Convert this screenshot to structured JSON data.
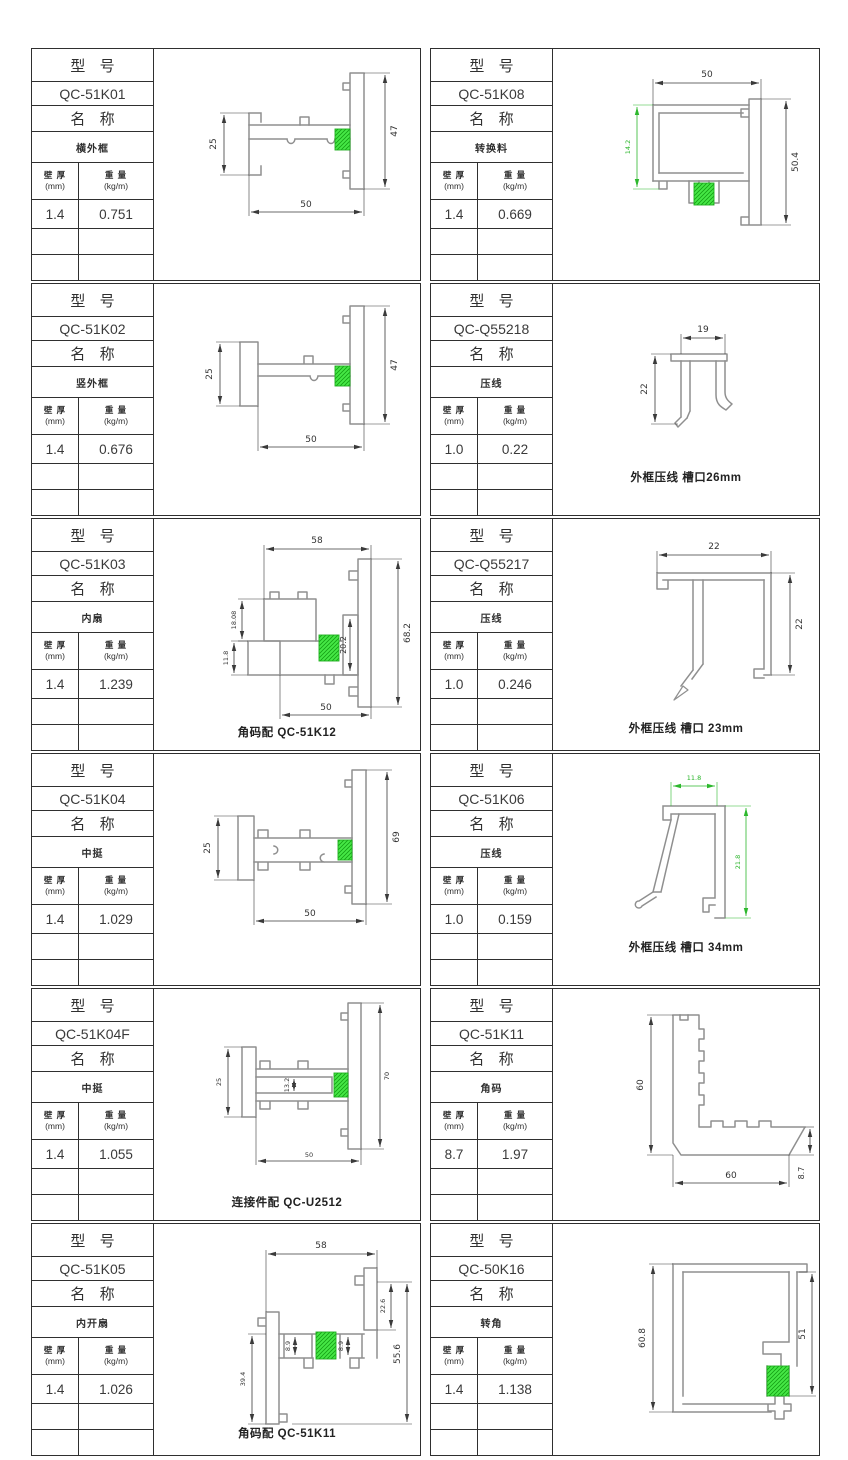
{
  "labels": {
    "model_header": "型 号",
    "name_header": "名 称",
    "thickness_header": "壁 厚",
    "thickness_unit": "(mm)",
    "weight_header": "重 量",
    "weight_unit": "(kg/m)"
  },
  "colors": {
    "line_gray": "#8f8f8f",
    "dim_black": "#3a3a3a",
    "highlight_green": "#3fe33f"
  },
  "panels": [
    {
      "model": "QC-51K01",
      "name": "横外框",
      "thickness": "1.4",
      "weight": "0.751",
      "note": "",
      "dims": {
        "left": "25",
        "right": "47",
        "bottom": "50"
      }
    },
    {
      "model": "QC-51K02",
      "name": "竖外框",
      "thickness": "1.4",
      "weight": "0.676",
      "note": "",
      "dims": {
        "left": "25",
        "right": "47",
        "bottom": "50"
      }
    },
    {
      "model": "QC-51K03",
      "name": "内扇",
      "thickness": "1.4",
      "weight": "1.239",
      "note": "角码配 QC-51K12",
      "dims": {
        "top": "58",
        "inner": "20.2",
        "right": "68.2",
        "bottom": "50",
        "left_upper": "18.08",
        "left_lower": "11.8"
      }
    },
    {
      "model": "QC-51K04",
      "name": "中挺",
      "thickness": "1.4",
      "weight": "1.029",
      "note": "",
      "dims": {
        "left": "25",
        "right": "69",
        "bottom": "50"
      }
    },
    {
      "model": "QC-51K04F",
      "name": "中挺",
      "thickness": "1.4",
      "weight": "1.055",
      "note": "连接件配 QC-U2512",
      "dims": {
        "left": "25",
        "inner": "13.2",
        "right": "70",
        "bottom": "50"
      }
    },
    {
      "model": "QC-51K05",
      "name": "内开扇",
      "thickness": "1.4",
      "weight": "1.026",
      "note": "角码配 QC-51K11",
      "dims": {
        "top": "58",
        "right_small": "22.6",
        "right": "55.6",
        "left": "39.4",
        "inner1": "8.9",
        "inner2": "8.9"
      }
    },
    {
      "model": "QC-51K08",
      "name": "转换料",
      "thickness": "1.4",
      "weight": "0.669",
      "note": "",
      "dims": {
        "top": "50",
        "right": "50.4",
        "left_green": "14.2"
      }
    },
    {
      "model": "QC-Q55218",
      "name": "压线",
      "thickness": "1.0",
      "weight": "0.22",
      "note": "外框压线  槽口26mm",
      "dims": {
        "top": "19",
        "left": "22"
      }
    },
    {
      "model": "QC-Q55217",
      "name": "压线",
      "thickness": "1.0",
      "weight": "0.246",
      "note": "外框压线  槽口 23mm",
      "dims": {
        "top": "22",
        "right": "22"
      }
    },
    {
      "model": "QC-51K06",
      "name": "压线",
      "thickness": "1.0",
      "weight": "0.159",
      "note": "外框压线  槽口 34mm",
      "dims": {
        "top": "11.8",
        "right": "21.8"
      }
    },
    {
      "model": "QC-51K11",
      "name": "角码",
      "thickness": "8.7",
      "weight": "1.97",
      "note": "",
      "dims": {
        "left": "60",
        "bottom": "60",
        "right": "8.7"
      }
    },
    {
      "model": "QC-50K16",
      "name": "转角",
      "thickness": "1.4",
      "weight": "1.138",
      "note": "",
      "dims": {
        "left": "60.8",
        "right": "51"
      }
    }
  ]
}
